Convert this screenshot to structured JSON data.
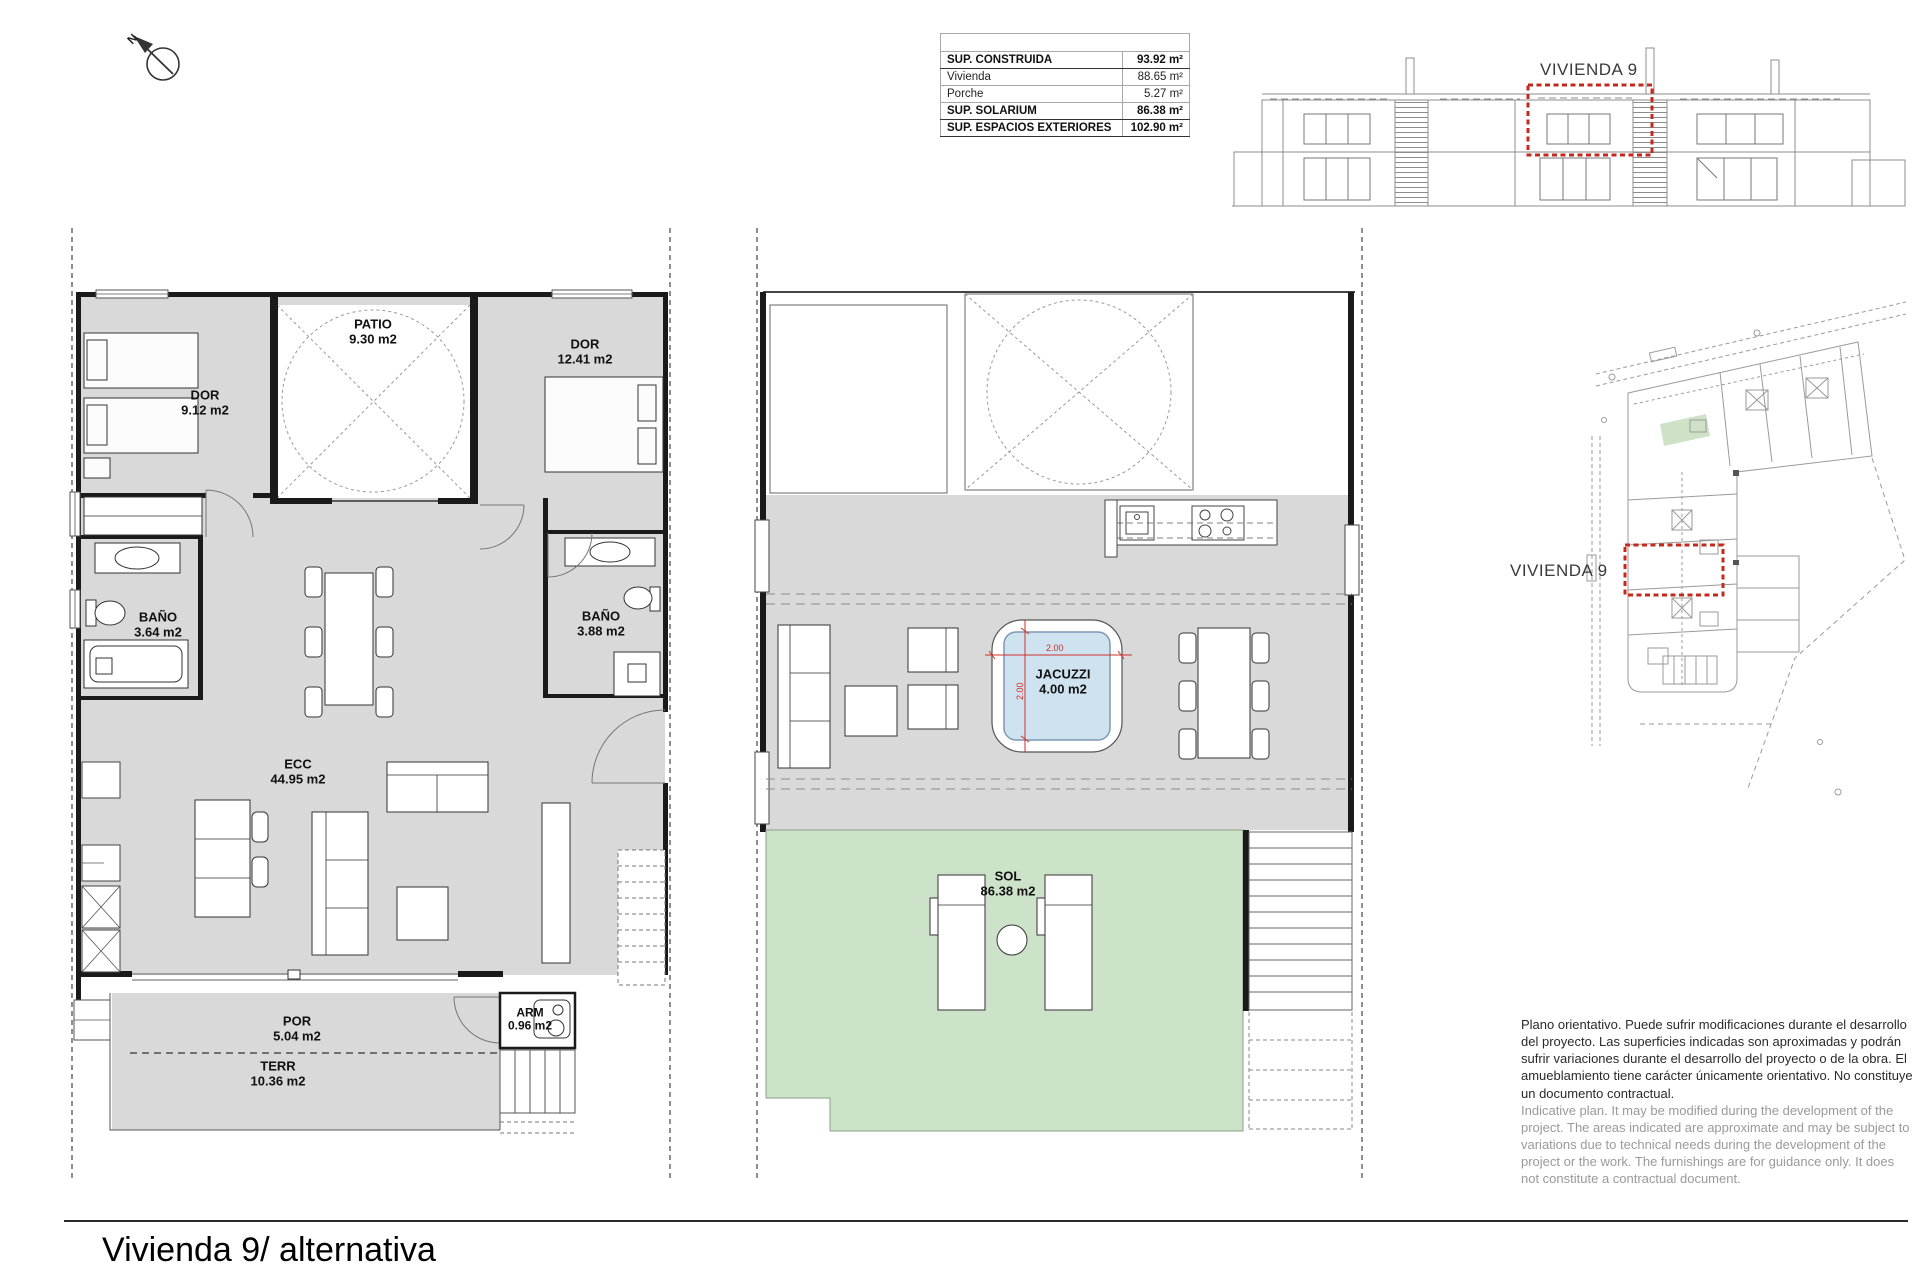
{
  "document": {
    "title": "Vivienda 9/ alternativa"
  },
  "compass": {
    "label": "N"
  },
  "areas_table": {
    "rows": [
      {
        "label": "SUP. CONSTRUIDA",
        "value": "93.92 m²",
        "bold": true
      },
      {
        "label": "Vivienda",
        "value": "88.65 m²",
        "bold": false
      },
      {
        "label": "Porche",
        "value": "5.27 m²",
        "bold": false
      },
      {
        "label": "SUP. SOLARIUM",
        "value": "86.38 m²",
        "bold": true
      },
      {
        "label": "SUP. ESPACIOS EXTERIORES",
        "value": "102.90 m²",
        "bold": true
      }
    ]
  },
  "elevation": {
    "unit_label": "VIVIENDA 9"
  },
  "site_plan": {
    "unit_label": "VIVIENDA 9"
  },
  "ground_floor": {
    "rooms": [
      {
        "name": "DOR",
        "area": "9.12 m2"
      },
      {
        "name": "PATIO",
        "area": "9.30 m2"
      },
      {
        "name": "DOR",
        "area": "12.41 m2"
      },
      {
        "name": "BAÑO",
        "area": "3.64 m2"
      },
      {
        "name": "BAÑO",
        "area": "3.88 m2"
      },
      {
        "name": "ECC",
        "area": "44.95 m2"
      },
      {
        "name": "POR",
        "area": "5.04 m2"
      },
      {
        "name": "ARM",
        "area": "0.96 m2"
      },
      {
        "name": "TERR",
        "area": "10.36 m2"
      }
    ]
  },
  "solarium": {
    "rooms": [
      {
        "name": "JACUZZI",
        "area": "4.00 m2"
      },
      {
        "name": "SOL",
        "area": "86.38 m2"
      }
    ],
    "jacuzzi_width": "2.00",
    "jacuzzi_depth": "2.00"
  },
  "disclaimer": {
    "es": "Plano orientativo. Puede sufrir modificaciones durante el desarrollo del proyecto. Las superficies indicadas son aproximadas y podrán sufrir variaciones durante el desarrollo del proyecto o de la obra. El amueblamiento tiene carácter únicamente orientativo. No constituye un documento contractual.",
    "en": "Indicative plan. It may be modified during the development of the project. The areas indicated are approximate and may be subject to variations due to technical needs during the development of the project or the work. The furnishings are for guidance only. It does not constitute a contractual document."
  },
  "colors": {
    "floor_gray": "#d9d9d9",
    "sol_green": "#cde3c9",
    "jacuzzi_blue": "#cfe2f0",
    "highlight_red": "#c5281c"
  }
}
